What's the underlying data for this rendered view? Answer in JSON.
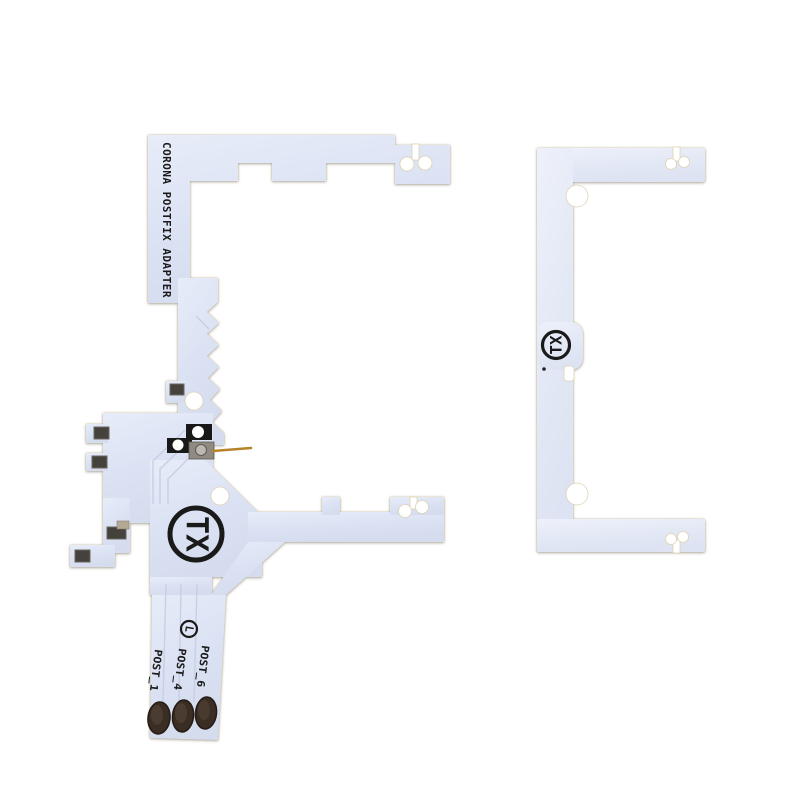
{
  "photo": {
    "background_color": "#ffffff",
    "left_board": {
      "silkscreen_title": "CORONA POSTFIX ADAPTER",
      "logo_text": "TX",
      "circled_mark": "L",
      "post_labels": [
        "POST_1",
        "POST_4",
        "POST_6"
      ]
    },
    "right_board": {
      "logo_text": "TX"
    },
    "colors": {
      "pcb_left": "#d9e0f1",
      "pcb_left_light": "#e7ecf8",
      "pcb_right": "#e2e7f5",
      "pcb_right_light": "#eef1fa",
      "board_edge": "#cfc094",
      "silkscreen": "#1a1a1a",
      "solder_pad": "#45413c",
      "component_black": "#181818",
      "component_silver": "#8f8a82",
      "gold_pin": "#b5832a",
      "contact_pad_dark": "#3a2d24",
      "trace": "#c7cee3"
    }
  }
}
